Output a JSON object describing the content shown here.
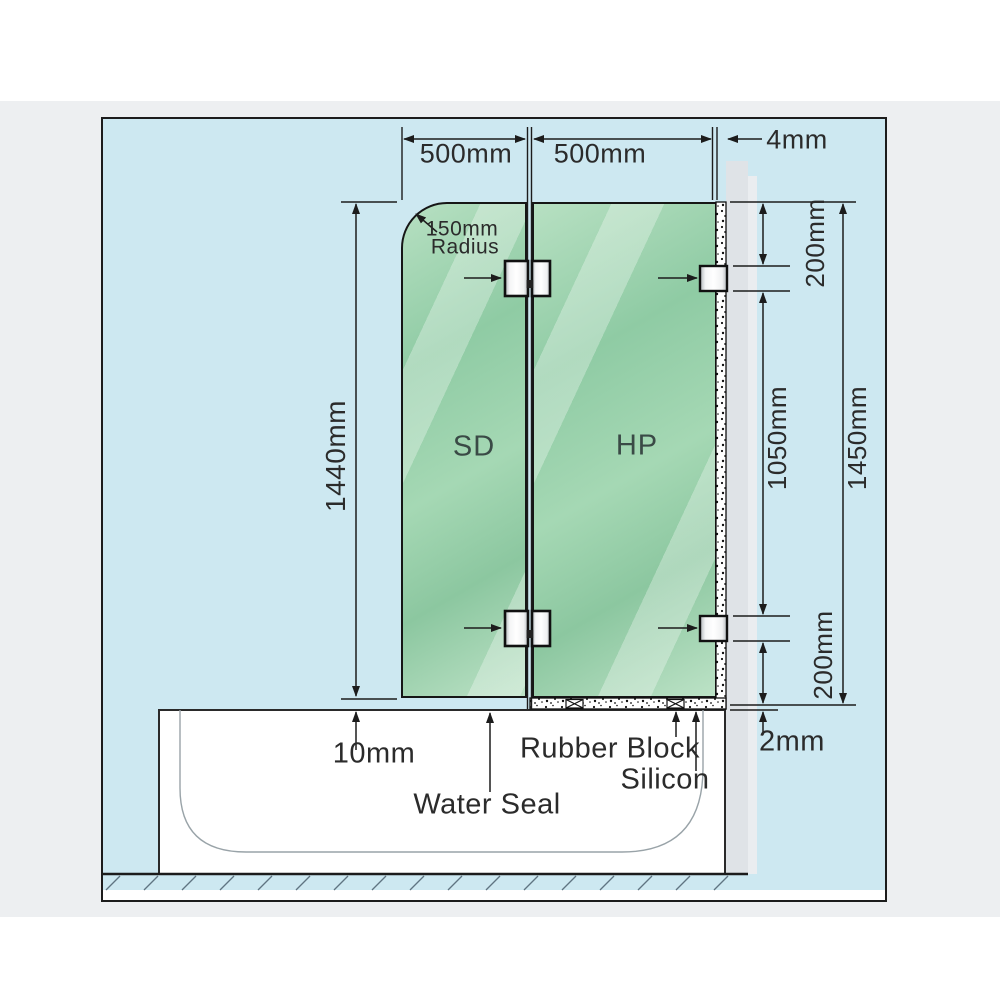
{
  "diagram": {
    "top_dimensions": {
      "sd_width": "500mm",
      "hp_width": "500mm",
      "wall_gap": "4mm"
    },
    "corner_note": {
      "line1": "150mm",
      "line2": "Radius"
    },
    "left_dimensions": {
      "glass_height": "1440mm",
      "bottom_gap": "10mm"
    },
    "right_dimensions": {
      "top_bracket_offset": "200mm",
      "bracket_spacing": "1050mm",
      "overall_height": "1450mm",
      "bottom_bracket_offset": "200mm",
      "base_gap": "2mm"
    },
    "panels": {
      "left_label": "SD",
      "right_label": "HP"
    },
    "bottom_labels": {
      "water_seal": "Water Seal",
      "rubber_block": "Rubber Block",
      "silicon": "Silicon"
    },
    "colors": {
      "page_background": "#ffffff",
      "canvas_band": "#edeff1",
      "diagram_background": "#cde8f1",
      "glass_green": "#9ad0ab",
      "wall_gray": "#dfe3e7",
      "line": "#1c1c1c"
    }
  }
}
